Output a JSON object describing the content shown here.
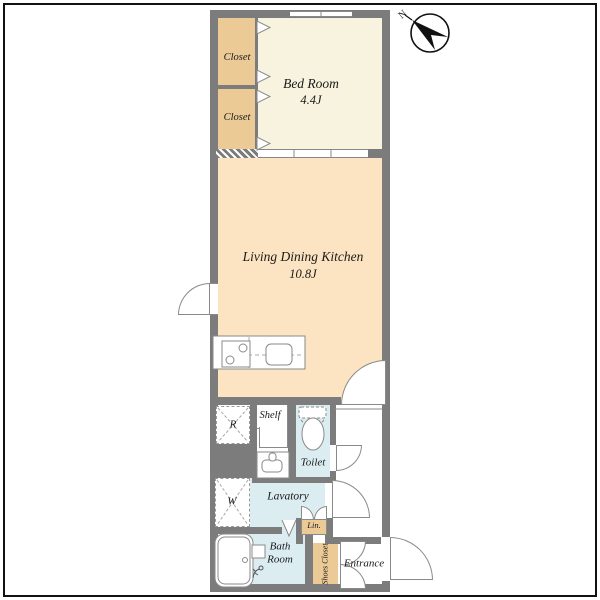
{
  "plan": {
    "type": "apartment-floor-plan",
    "rooms": {
      "closet_upper": {
        "label": "Closet"
      },
      "closet_lower": {
        "label": "Closet"
      },
      "bedroom": {
        "label": "Bed Room",
        "size": "4.4J"
      },
      "ldk": {
        "label": "Living Dining Kitchen",
        "size": "10.8J"
      },
      "toilet": {
        "label": "Toilet"
      },
      "lavatory": {
        "label": "Lavatory"
      },
      "bathroom": {
        "line1": "Bath",
        "line2": "Room"
      },
      "entrance": {
        "label": "Entrance"
      },
      "shoes_closet": {
        "label": "Shoes Closet"
      },
      "linen": {
        "label": "Lin."
      }
    },
    "fixtures": {
      "shelf": {
        "label": "Shelf"
      },
      "refrigerator": {
        "label": "R"
      },
      "washer": {
        "label": "W"
      }
    },
    "compass": {
      "label": "N"
    },
    "colors": {
      "wall": "#7c7c7c",
      "closet_fill": "#ebca96",
      "bedroom_fill": "#f8f3df",
      "ldk_fill": "#fce3c1",
      "wet_room_fill": "#dcedf2",
      "line": "#8a8a8a",
      "frame": "#111111"
    }
  }
}
